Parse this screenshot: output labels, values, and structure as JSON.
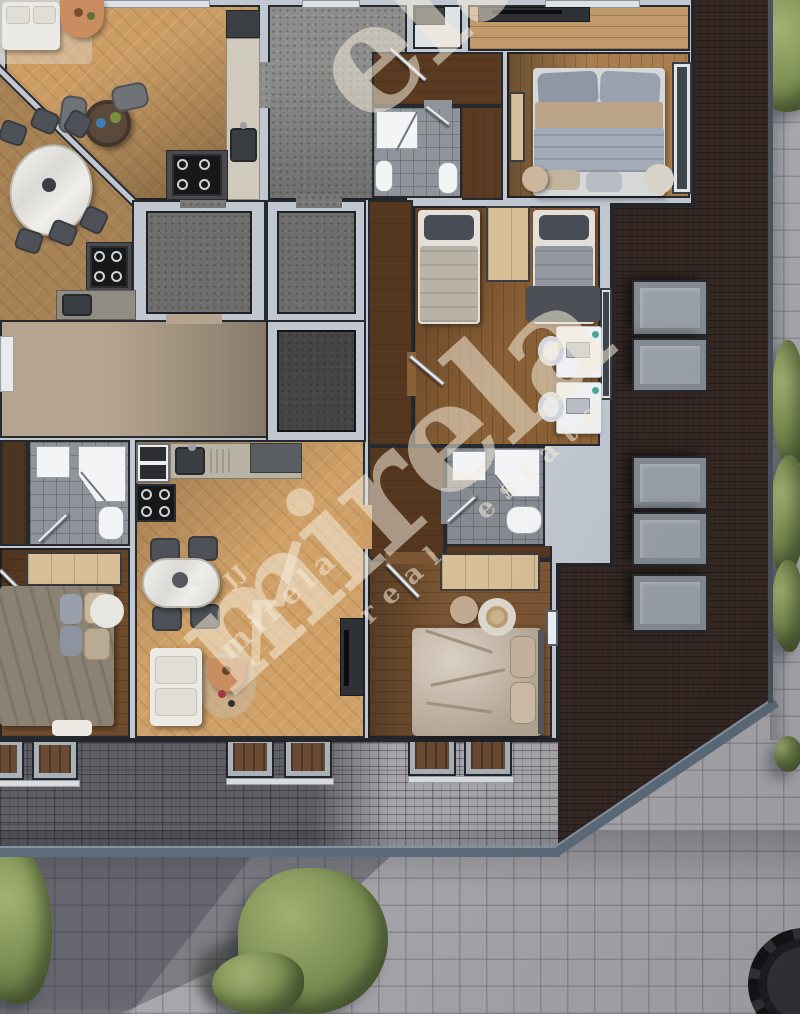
{
  "title": "apartment-building-floor-plan-render",
  "watermark": {
    "brand_large": "mirela",
    "brand_partial": "ela",
    "brand_small": "mirela",
    "tagline": "real estate",
    "logo_monogram": "JJ",
    "color": "rgba(244,235,216,0.55)"
  },
  "scene": {
    "type": "3d-top-down-floor-plan",
    "skylight_count": 5,
    "roof_window_count": 6
  },
  "colors": {
    "pavement": "#a8a8ac",
    "roof_dark": "#352824",
    "gutter": "#5d6c7b",
    "wall": "#c1c7d0",
    "wood_light": "#cb9d65",
    "wood_mid": "#a97f50",
    "wood_plank": "#8a6036",
    "walnut": "#5a3b22",
    "carpet": "#b5a48f",
    "terrazzo": "#8d8d8b",
    "terrazzo_dark": "#6a6a68",
    "charcoal": "#3f4042",
    "tile": "#8f949a",
    "white_floor": "#e0e3e6",
    "marble": "#e9e7e2",
    "sofa": "#eceae4",
    "chair_dark": "#4e5258",
    "bed_gray": "#9aa3b0",
    "bed_beige": "#cfc3b4",
    "wardrobe": "#d8bf97",
    "accent_orange": "#c98d5f",
    "green": "#7d8f52",
    "sky_frame": "#858b93",
    "sky_glass": "#9aa0a8",
    "watermark": "rgba(244,235,216,0.55)"
  }
}
